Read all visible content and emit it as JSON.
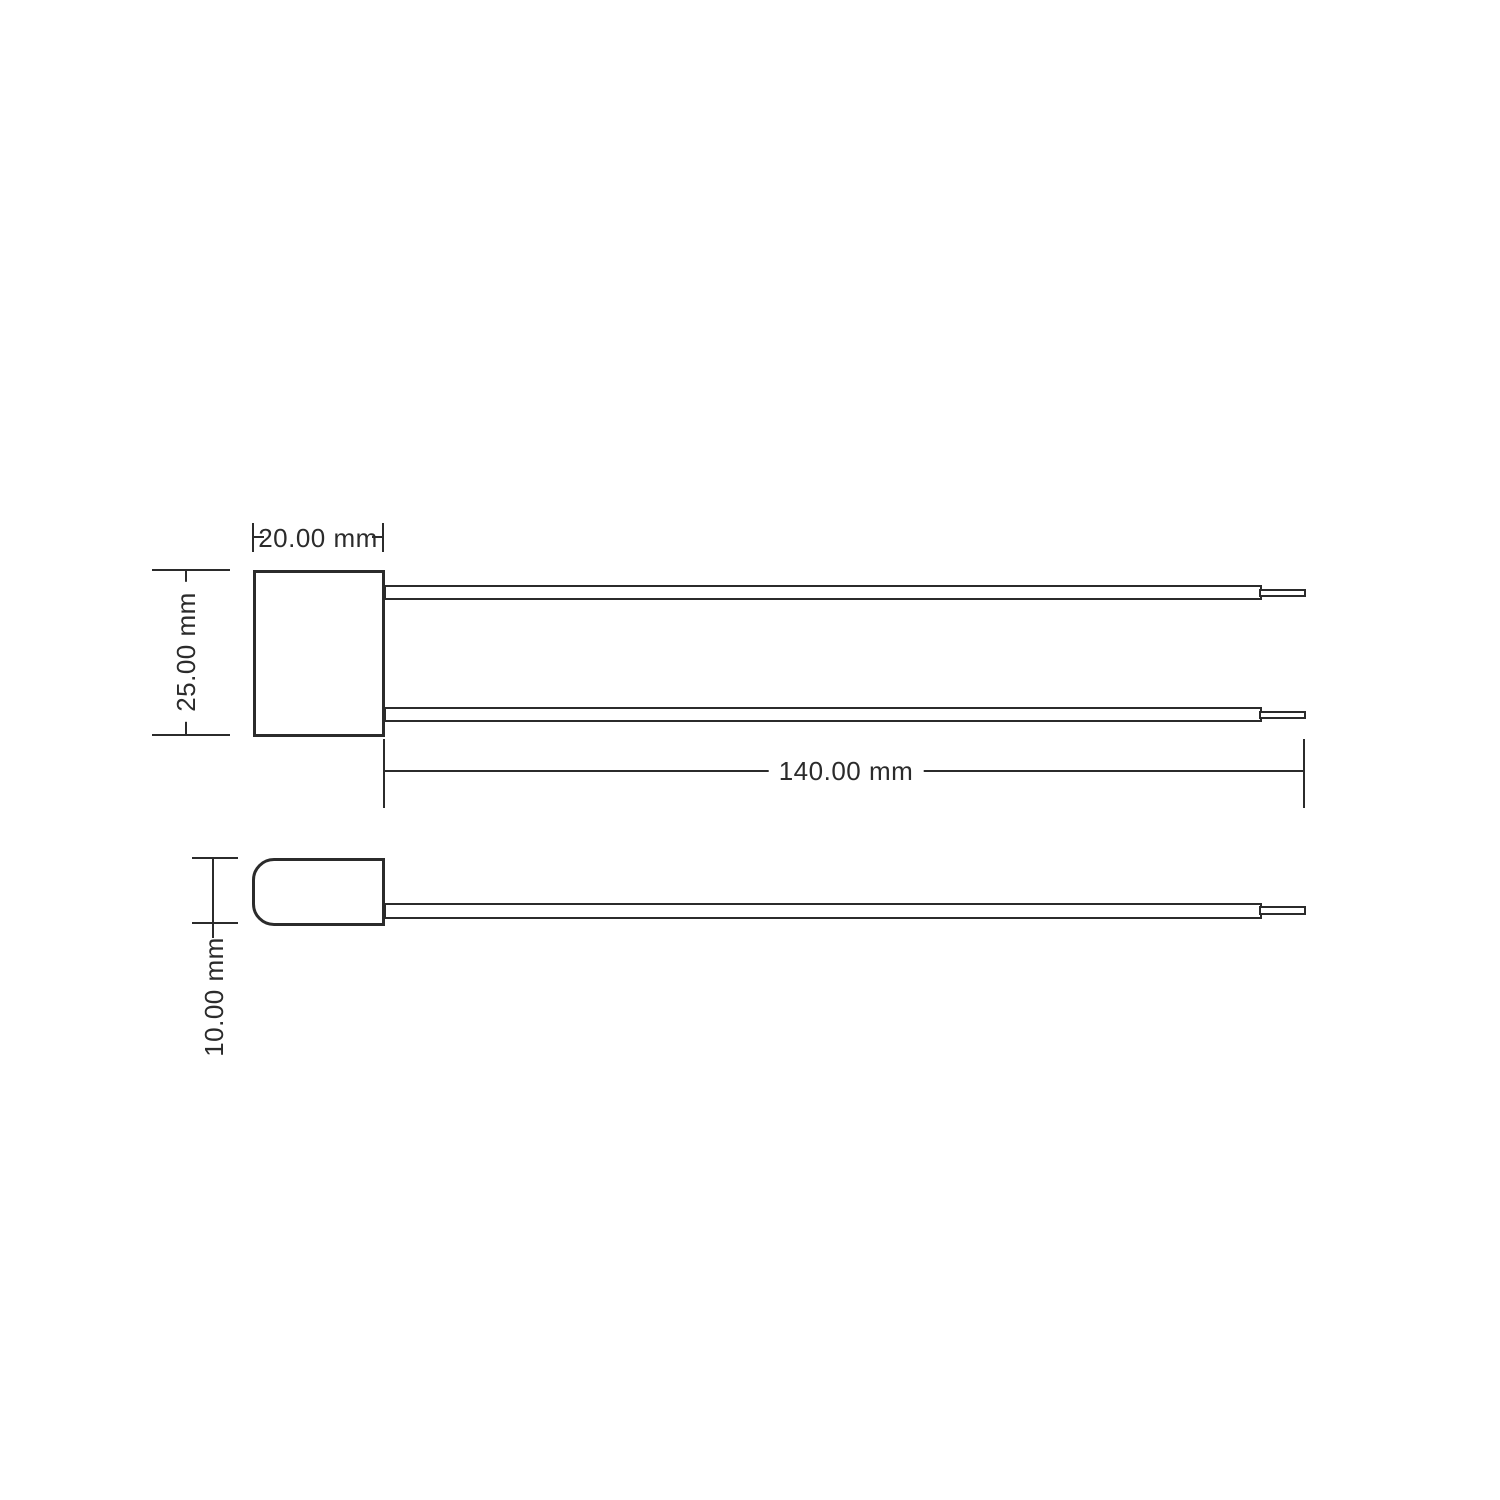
{
  "drawing": {
    "kind": "technical-dimension-drawing",
    "colors": {
      "line": "#2b2b2b",
      "background": "#ffffff"
    },
    "dimensions": {
      "body_width": {
        "label": "20.00 mm",
        "value": 20.0,
        "unit": "mm"
      },
      "body_height": {
        "label": "25.00 mm",
        "value": 25.0,
        "unit": "mm"
      },
      "lead_length": {
        "label": "140.00 mm",
        "value": 140.0,
        "unit": "mm"
      },
      "body_thickness": {
        "label": "10.00 mm",
        "value": 10.0,
        "unit": "mm"
      }
    }
  }
}
